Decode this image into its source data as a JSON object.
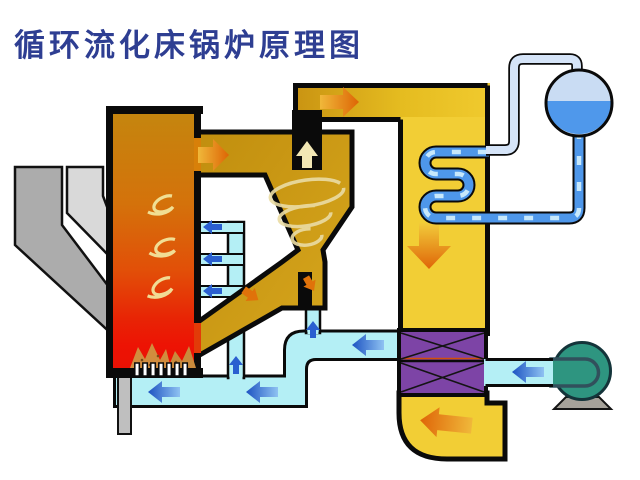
{
  "title": {
    "text": "循环流化床锅炉原理图"
  },
  "palette": {
    "title_text": "#2E3E92",
    "background": "#FFFFFF",
    "outline": "#0A0A0A",
    "furnace_top": "#C4860E",
    "furnace_bottom": "#ED1304",
    "hot_duct_gold": "#CE9712",
    "backpass_yellow": "#F2CE35",
    "air_heater_purple": "#7D44A6",
    "air_cyan": "#B4EFF5",
    "pipe_blue": "#4E97EA",
    "pipe_light": "#D5E4F8",
    "pipe_dash": "#C7E8FB",
    "drum_steam": "#C9DCF3",
    "drum_water": "#4F98EB",
    "fan_teal": "#2E9580",
    "fan_base_gray": "#A6A29A",
    "chute_dark": "#ACACAC",
    "chute_light": "#D9D9D9",
    "drain_gray": "#BFBFBF",
    "arrow_orange_tip": "#DD6505",
    "arrow_blue": "#2A5FD0",
    "swirl_yellow": "#F3E9A0",
    "flame_tan": "#D09441"
  },
  "components": [
    {
      "name": "furnace",
      "desc": "riser combustion chamber, orange-to-red gradient, internal gas swirls and bed flames"
    },
    {
      "name": "fuel-chute",
      "desc": "dark gray feed chute entering furnace"
    },
    {
      "name": "limestone-chute",
      "desc": "light gray feed chute entering furnace"
    },
    {
      "name": "cyclone-separator",
      "desc": "gold cyclone with vortex spiral and black vortex finder"
    },
    {
      "name": "loop-seal",
      "desc": "U-leg solids return seal under cyclone"
    },
    {
      "name": "solids-return-duct",
      "desc": "diagonal recycle duct back to furnace"
    },
    {
      "name": "crossover-duct",
      "desc": "hot flue gas duct from cyclone to backpass"
    },
    {
      "name": "convective-backpass",
      "desc": "yellow downflow gas pass"
    },
    {
      "name": "superheater-coil",
      "desc": "blue serpentine tube bank in backpass"
    },
    {
      "name": "steam-drum",
      "desc": "drum half steam / half water with riser and downcomer piping"
    },
    {
      "name": "air-preheater",
      "desc": "purple crossed-plate heat exchanger"
    },
    {
      "name": "flue-gas-exit-elbow",
      "desc": "yellow elbow below air preheater"
    },
    {
      "name": "forced-draft-fan",
      "desc": "teal centrifugal fan on gray pedestal"
    },
    {
      "name": "windbox-plenum",
      "desc": "cyan primary air plenum under grid"
    },
    {
      "name": "grid-nozzles",
      "desc": "row of white air distributor nozzles"
    },
    {
      "name": "secondary-air-header",
      "desc": "vertical cyan header with three injection bars"
    },
    {
      "name": "loop-seal-air-pipe",
      "desc": "small cyan aeration pipe to loop seal"
    },
    {
      "name": "ash-drain-pipe",
      "desc": "gray bottom ash drain"
    }
  ],
  "flows": {
    "flue_gas": "furnace → cyclone → crossover duct → backpass → air preheater → exit elbow",
    "air": "fan → air preheater → windbox and secondary air → furnace",
    "steam_water": "drum → downcomer → superheater coil → riser pipe → drum"
  }
}
